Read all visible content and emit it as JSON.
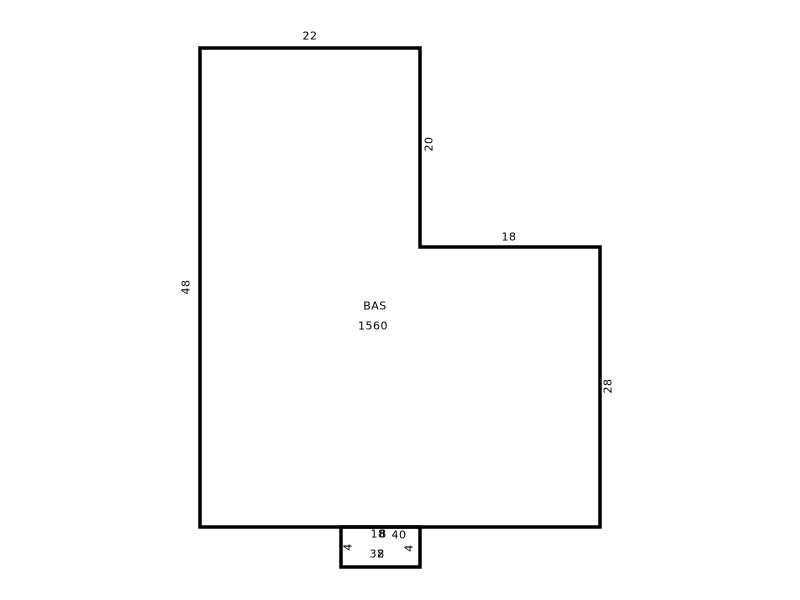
{
  "diagram": {
    "type": "floor-plan-sketch",
    "canvas": {
      "width": 800,
      "height": 600,
      "background": "#ffffff"
    },
    "style": {
      "line_color": "#000000",
      "text_color": "#000000",
      "stroke_width": 3.5,
      "font_size": 11
    },
    "area": {
      "name": "BAS",
      "size": "1560"
    },
    "polygons": [
      {
        "name": "main-outline",
        "points": "200,48 420,48 420,247 600,247 600,527 200,527"
      },
      {
        "name": "stoop-outline",
        "points": "341,527 420,527 420,567 341,567"
      }
    ],
    "labels": [
      {
        "name": "area-name-bas",
        "text": "BAS",
        "x": 375,
        "y": 306,
        "rot": 0
      },
      {
        "name": "area-size-bas",
        "text": "1560",
        "x": 373,
        "y": 326,
        "rot": 0
      },
      {
        "name": "dim-top",
        "text": "22",
        "x": 310,
        "y": 36,
        "rot": 0
      },
      {
        "name": "dim-upper-right-vertical",
        "text": "20",
        "x": 429,
        "y": 144,
        "rot": -90
      },
      {
        "name": "dim-step",
        "text": "18",
        "x": 509,
        "y": 237,
        "rot": 0
      },
      {
        "name": "dim-left",
        "text": "48",
        "x": 186,
        "y": 287,
        "rot": -90
      },
      {
        "name": "dim-lower-right",
        "text": "28",
        "x": 608,
        "y": 386,
        "rot": -90
      },
      {
        "name": "dim-bottom",
        "text": "40",
        "x": 399,
        "y": 535,
        "rot": 0
      },
      {
        "name": "dim-stoop-top",
        "text": "18",
        "x": 378,
        "y": 534,
        "rot": 0
      },
      {
        "name": "dim-stoop-top-overlap",
        "text": "8",
        "x": 383,
        "y": 534,
        "rot": 0
      },
      {
        "name": "dim-stoop-left",
        "text": "4",
        "x": 348,
        "y": 547,
        "rot": -90
      },
      {
        "name": "dim-stoop-right",
        "text": "4",
        "x": 409,
        "y": 548,
        "rot": -90
      },
      {
        "name": "dim-stoop-bottom",
        "text": "32",
        "x": 377,
        "y": 554,
        "rot": 0
      },
      {
        "name": "dim-stoop-bottom-overlap",
        "text": "8",
        "x": 381,
        "y": 554,
        "rot": 0
      }
    ]
  }
}
